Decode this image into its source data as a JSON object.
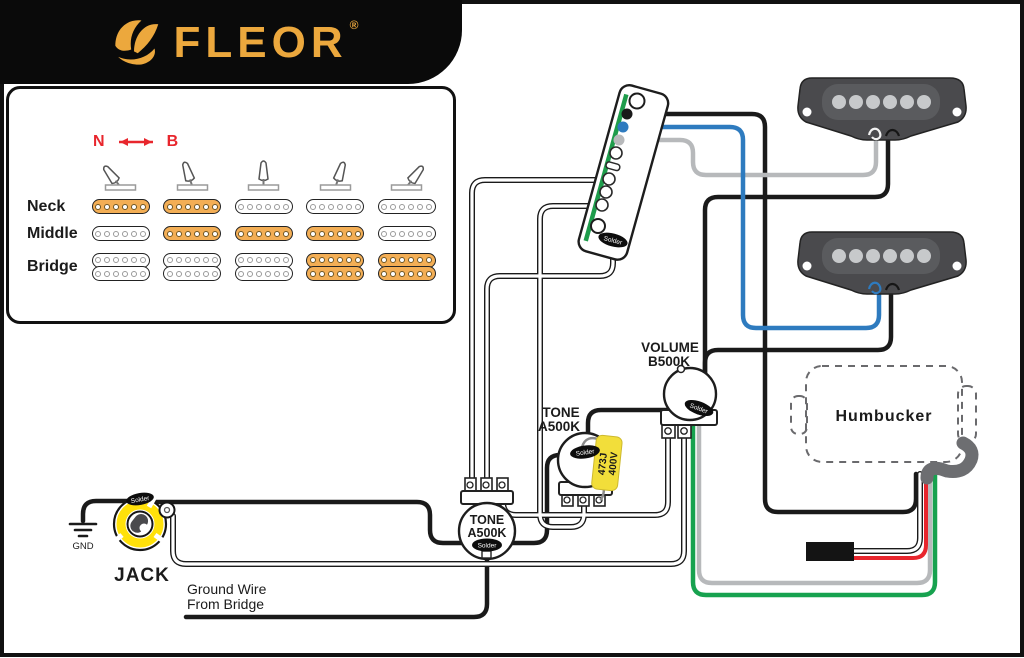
{
  "brand": {
    "name": "FLEOR",
    "registered": "®"
  },
  "legend": {
    "neck_mark": "N",
    "bridge_mark": "B",
    "lever_angles": [
      -38,
      -18,
      0,
      18,
      38
    ],
    "rows": [
      {
        "label": "Neck",
        "coils": 1,
        "active": [
          1,
          1,
          0,
          0,
          0
        ]
      },
      {
        "label": "Middle",
        "coils": 1,
        "active": [
          0,
          1,
          1,
          1,
          0
        ]
      },
      {
        "label": "Bridge",
        "coils": 2,
        "active": [
          0,
          0,
          0,
          1,
          1
        ]
      }
    ]
  },
  "components": {
    "volume": {
      "line1": "VOLUME",
      "line2": "B500K"
    },
    "tone1": {
      "line1": "TONE",
      "line2": "A500K"
    },
    "tone2": {
      "line1": "TONE",
      "line2": "A500K"
    },
    "capacitor": {
      "line1": "473J",
      "line2": "400V"
    },
    "jack": {
      "label": "JACK"
    },
    "gnd": {
      "label": "GND"
    },
    "humbucker": {
      "label": "Humbucker"
    },
    "solder_label": "Solder",
    "note": {
      "line1": "Ground Wire",
      "line2": "From Bridge"
    }
  },
  "colors": {
    "accent_gold": "#ECA83D",
    "active_orange": "#F3AE55",
    "wire_black": "#1a1a1a",
    "wire_blue": "#2E7BBF",
    "wire_green": "#17A24F",
    "wire_red": "#E8262D",
    "wire_gray": "#B7B9BB",
    "cable_gray": "#6D6E71",
    "cap_yellow": "#F2DE3A",
    "jack_yellow": "#FFE10A",
    "pcb_green": "#1E9C4B"
  }
}
